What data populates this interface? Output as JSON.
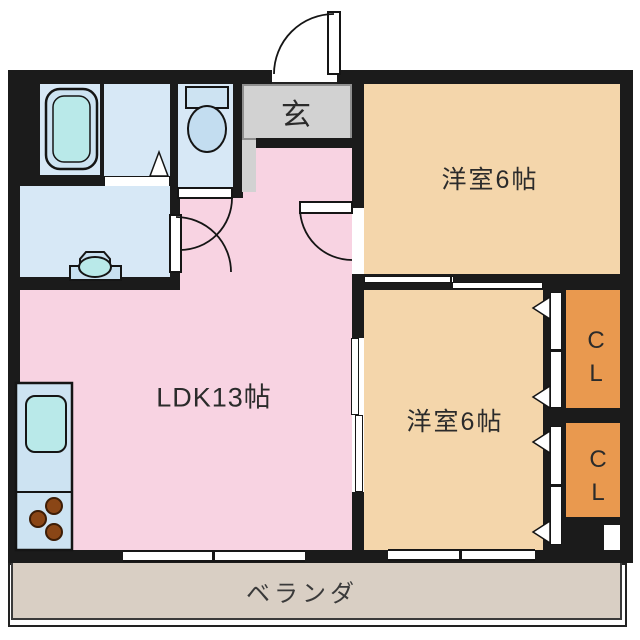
{
  "floorplan": {
    "type": "apartment-floor-plan",
    "rooms": {
      "ldk": {
        "label": "LDK13帖"
      },
      "bedroom_top": {
        "label": "洋室6帖"
      },
      "bedroom_bottom": {
        "label": "洋室6帖"
      },
      "genkan": {
        "label": "玄"
      },
      "closet_top": {
        "label": "CL"
      },
      "closet_bottom": {
        "label": "CL"
      },
      "balcony": {
        "label": "ベランダ"
      }
    },
    "fixtures": [
      "bathtub",
      "washbasin",
      "toilet",
      "kitchen-sink",
      "stove-3-burners",
      "entrance-door",
      "hinged-doors",
      "sliding-doors",
      "folding-closet-doors",
      "windows"
    ],
    "colors": {
      "wall": "#1b1b1b",
      "ldk": "#f8d3e2",
      "bedroom": "#f4d6ab",
      "closet": "#e9994f",
      "wet_area": "#d7e8f6",
      "water_fixture": "#b9e9e9",
      "genkan": "#d2d2d2",
      "balcony": "#d9cfc4"
    }
  }
}
